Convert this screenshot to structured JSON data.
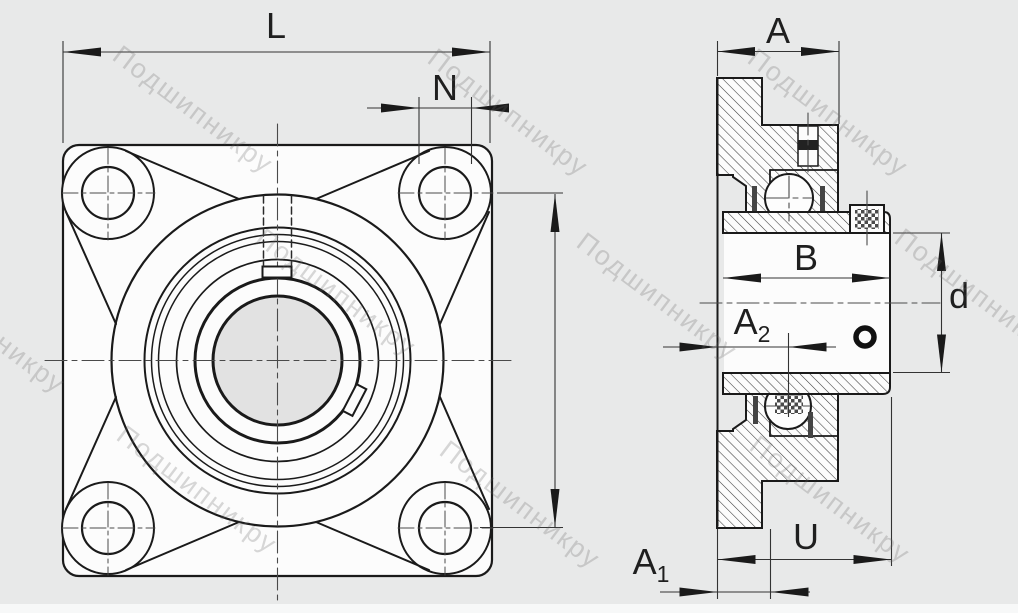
{
  "drawing": {
    "title": "flanged-bearing-unit-two-view-drawing",
    "watermark": {
      "text": "Подшипникру",
      "color": "rgba(100,100,100,0.25)"
    },
    "colors": {
      "background": "#e8e9e9",
      "paper": "#fcfcfc",
      "line": "#1a1a1a",
      "thin_line": "#3c3c3c",
      "bore_fill": "#e2e2e2"
    },
    "dimensions": {
      "L": {
        "label": "L"
      },
      "N": {
        "label": "N"
      },
      "A": {
        "label": "A"
      },
      "B": {
        "label": "B"
      },
      "d": {
        "label": "d"
      },
      "A2": {
        "label": "A",
        "sub": "2"
      },
      "A1": {
        "label": "A",
        "sub": "1"
      },
      "U": {
        "label": "U"
      }
    }
  }
}
